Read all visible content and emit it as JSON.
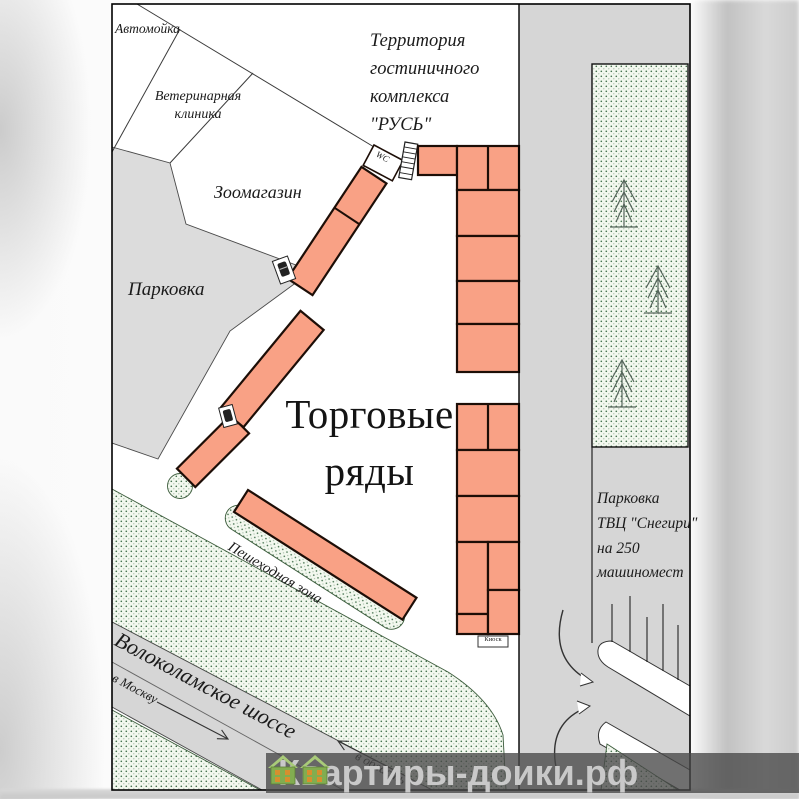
{
  "plan": {
    "car_wash": "Автомойка",
    "vet_clinic_lines": [
      "Ветеринарная",
      "клиника"
    ],
    "pet_shop": "Зоомагазин",
    "hotel_territory_lines": [
      "Территория",
      "гостиничного",
      "комплекса",
      "\"РУСЬ\""
    ],
    "parking": "Парковка",
    "market_title_lines": [
      "Торговые",
      "ряды"
    ],
    "wc": "WC",
    "kiosk": "Киоск",
    "pedestrian_zone": "Пешеходная зона",
    "highway_name": "Волоколамское шоссе",
    "direction_moscow": "в Москву",
    "direction_oblast": "в область",
    "snegiri_parking_lines": [
      "Парковка",
      "ТВЦ \"Снегири\"",
      "на 250",
      "машиномест"
    ]
  },
  "watermark": {
    "prefix": "Квартиры-до",
    "suffix": "ики.рф"
  },
  "colors": {
    "block_fill": "#F9A185",
    "block_stroke": "#1d0e07",
    "parking_gray": "#dcdcdc",
    "street_gray": "#d6d6d6",
    "green_dot": "#41704b",
    "green_bg": "#f3f8ef",
    "watermark_bg": "rgba(72,72,72,0.78)",
    "watermark_text": "#c9c9c9",
    "house_green": "#82ad50"
  }
}
